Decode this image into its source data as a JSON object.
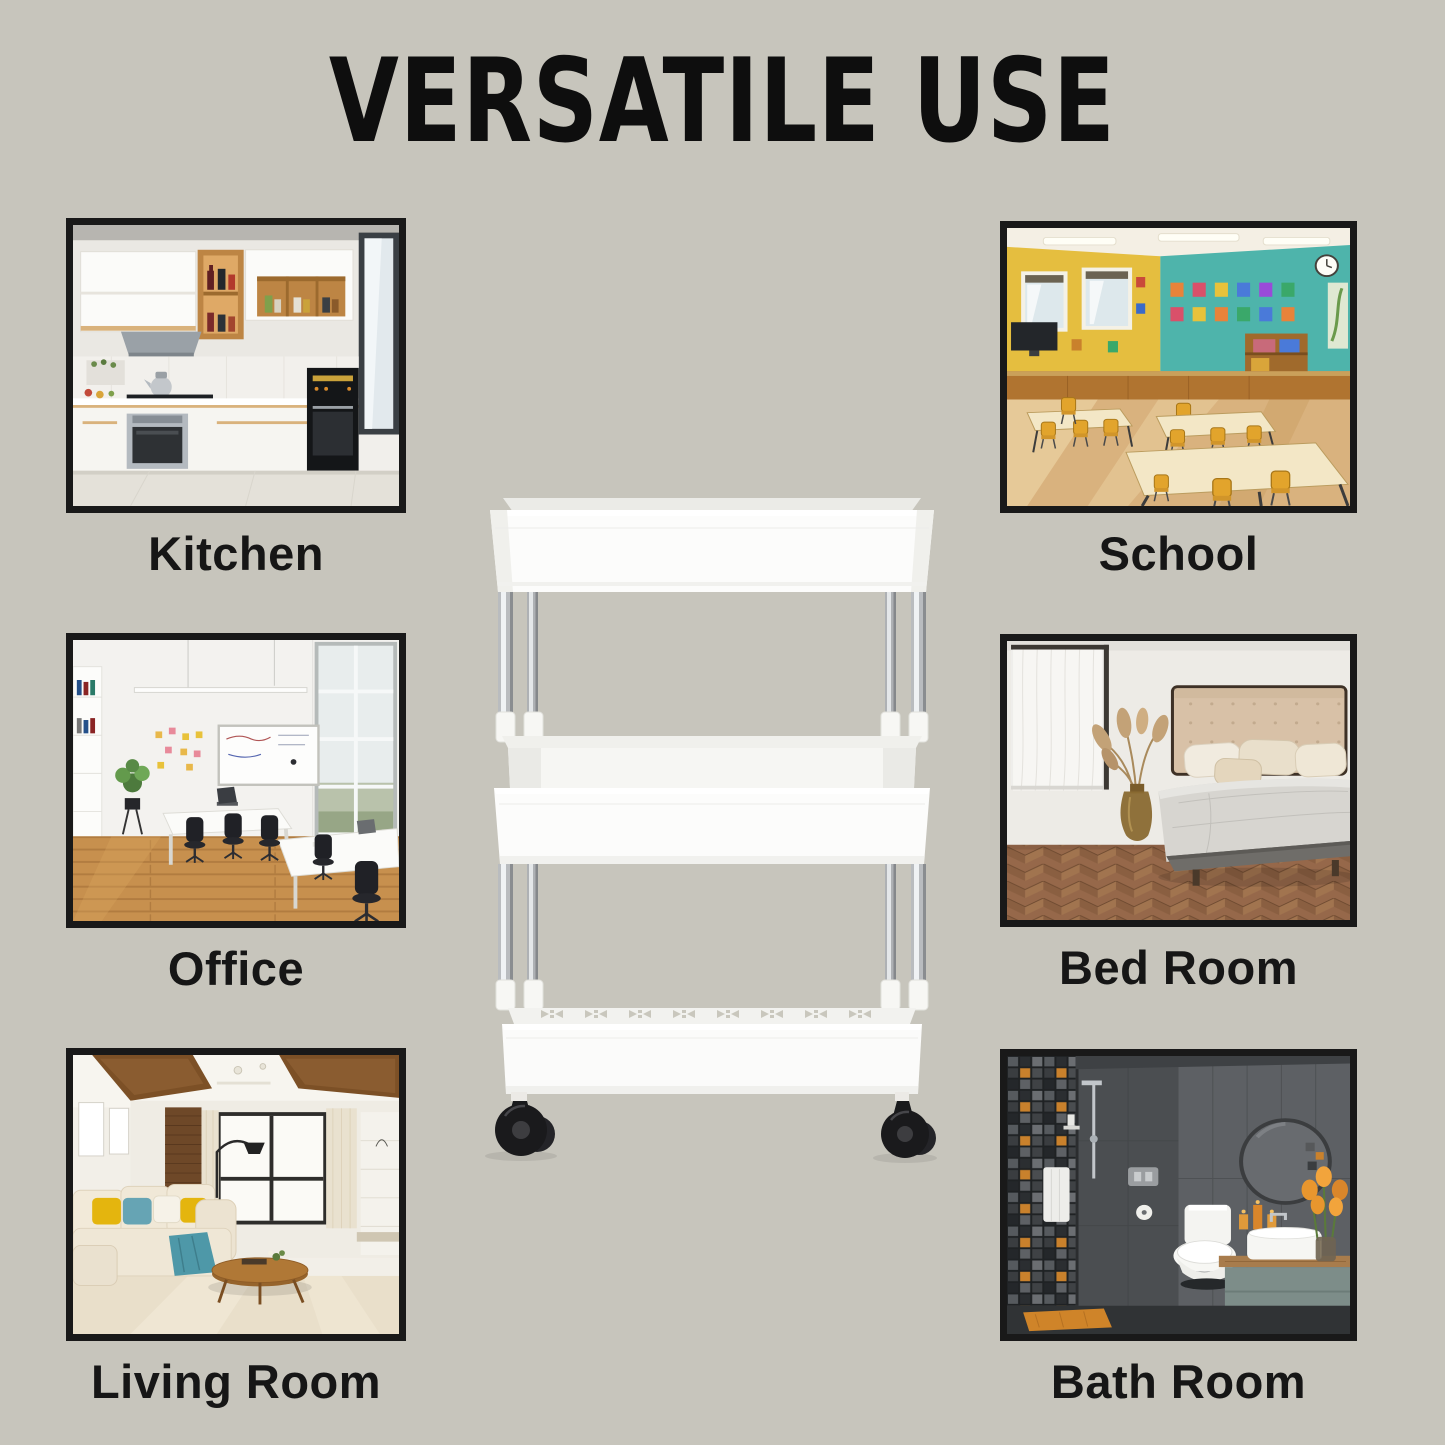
{
  "page": {
    "title": "VERSATILE USE"
  },
  "colors": {
    "background": "#c7c5bc",
    "text": "#121212",
    "photo_frame": "#191919",
    "product_white": "#fbfbfa",
    "caster_black": "#1a1a1c"
  },
  "tiles": [
    {
      "label": "Kitchen",
      "icon": "kitchen-photo"
    },
    {
      "label": "School",
      "icon": "school-photo"
    },
    {
      "label": "Office",
      "icon": "office-photo"
    },
    {
      "label": "Bed Room",
      "icon": "bedroom-photo"
    },
    {
      "label": "Living Room",
      "icon": "living-room-photo"
    },
    {
      "label": "Bath Room",
      "icon": "bathroom-photo"
    }
  ],
  "product": {
    "icon": "three-tier-rolling-storage-cart"
  }
}
